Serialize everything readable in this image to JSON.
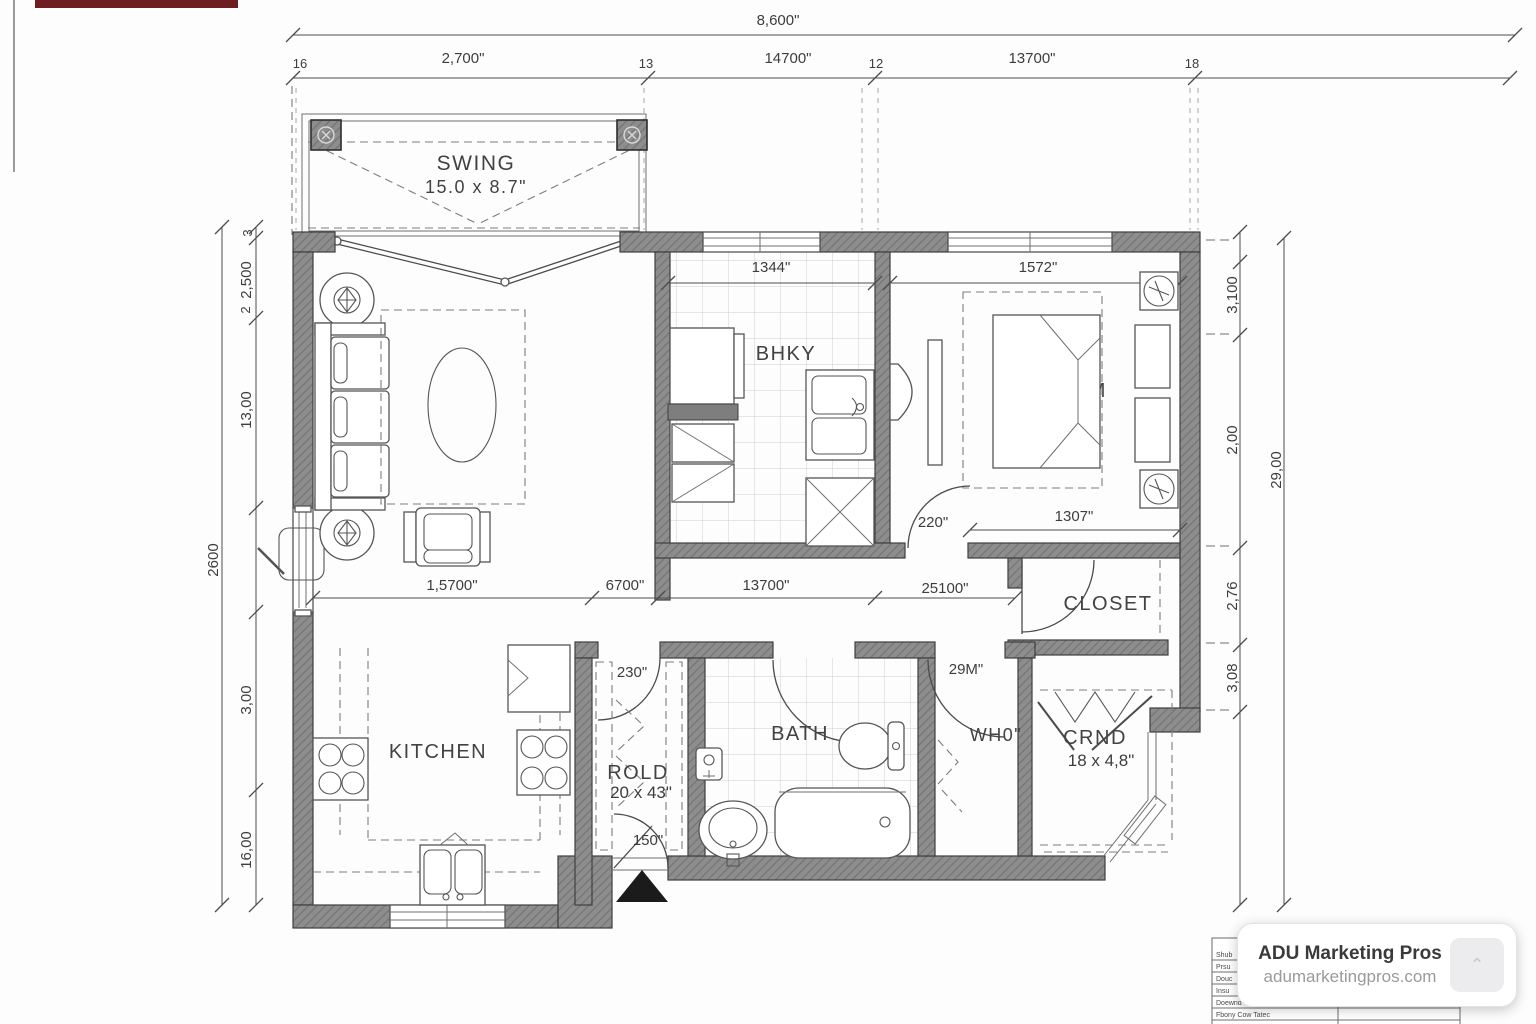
{
  "branding": {
    "name": "ADU Marketing Pros",
    "website": "adumarketingpros.com"
  },
  "colors": {
    "wall": "#8d8d8d",
    "accent_bar": "#6e1d20"
  },
  "rooms": {
    "swing": {
      "name": "SWING",
      "size": "15.0 x 8.7\""
    },
    "entry": {
      "name": "BHKY",
      "dim": "1344\""
    },
    "bedroom": {
      "name": "BEDROOM",
      "dim_top": "1572\"",
      "dim_bottom": "1307\""
    },
    "closet": {
      "name": "CLOSET"
    },
    "kitchen": {
      "name": "KITCHEN"
    },
    "pantry": {
      "name": "ROLD",
      "size": "20 x 43\""
    },
    "bath": {
      "name": "BATH"
    },
    "utility": {
      "name": "WH0\""
    },
    "wardrobe": {
      "name": "CRND",
      "size": "18 x 4,8\""
    }
  },
  "doors": {
    "bedroom": "220\"",
    "pantry": "230\"",
    "utility": "29M\"",
    "front": "150\""
  },
  "dims": {
    "top_overall": "8,600\"",
    "top_row": [
      "16",
      "2,700\"",
      "13",
      "14700\"",
      "12",
      "13700\"",
      "18"
    ],
    "mid_row": [
      "1,5700\"",
      "6700\"",
      "13700\"",
      "25100\""
    ],
    "left_chain": [
      "3",
      "2,500",
      "2",
      "13,00",
      "3,00",
      "16,00"
    ],
    "left_overall": "2600",
    "right_chain": [
      "3,100",
      "2,00",
      "2,76",
      "3,08"
    ],
    "right_overall": "29,00"
  },
  "titleblock": {
    "rows": [
      "Shub",
      "Prsu",
      "Douc",
      "Insu",
      "Doewnd Gutgao",
      "Fbony Cow Tatec"
    ]
  }
}
